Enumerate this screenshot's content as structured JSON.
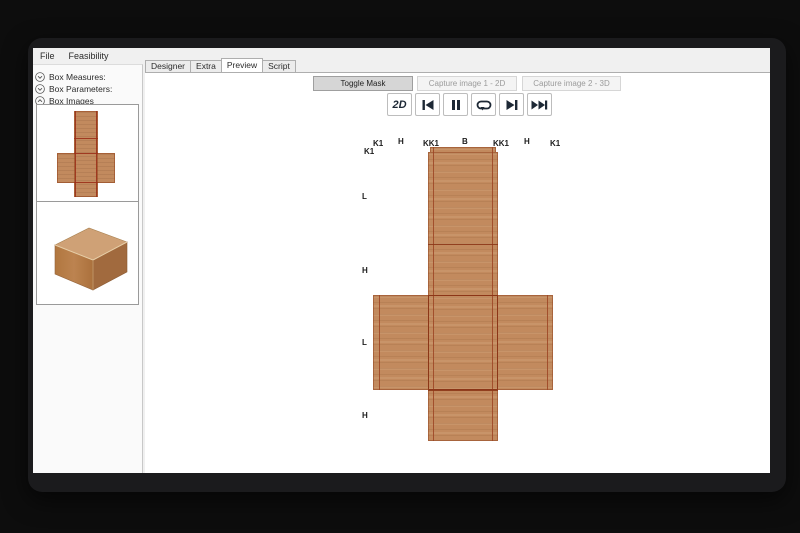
{
  "app": {
    "menu_items": [
      "File",
      "Feasibility"
    ],
    "tabs": [
      "Designer",
      "Extra",
      "Preview",
      "Script"
    ],
    "active_tab": "Preview"
  },
  "sidebar": {
    "sections": [
      {
        "label": "Box Measures:",
        "state": "collapsed"
      },
      {
        "label": "Box Parameters:",
        "state": "collapsed"
      },
      {
        "label": "Box Images",
        "state": "expanded"
      }
    ],
    "thumbnails": [
      "box-unfold-2d-thumbnail",
      "box-3d-thumbnail"
    ]
  },
  "toolbar": {
    "buttons": [
      {
        "label": "Toggle Mask",
        "enabled": true
      },
      {
        "label": "Capture image 1 - 2D",
        "enabled": false
      },
      {
        "label": "Capture image 2 - 3D",
        "enabled": false
      }
    ]
  },
  "playback": {
    "mode_button": "2D",
    "controls": [
      "skip-back",
      "pause",
      "loop",
      "next",
      "fast-forward"
    ]
  },
  "unfold": {
    "top_labels": [
      "K1",
      "K1",
      "H",
      "KK1",
      "B",
      "KK1",
      "H",
      "K1"
    ],
    "side_labels": [
      "L",
      "H",
      "L",
      "H"
    ],
    "colors": {
      "cardboard": "#c28a5e",
      "fold_line": "#9c4423",
      "panel_border": "#8c3617"
    }
  }
}
